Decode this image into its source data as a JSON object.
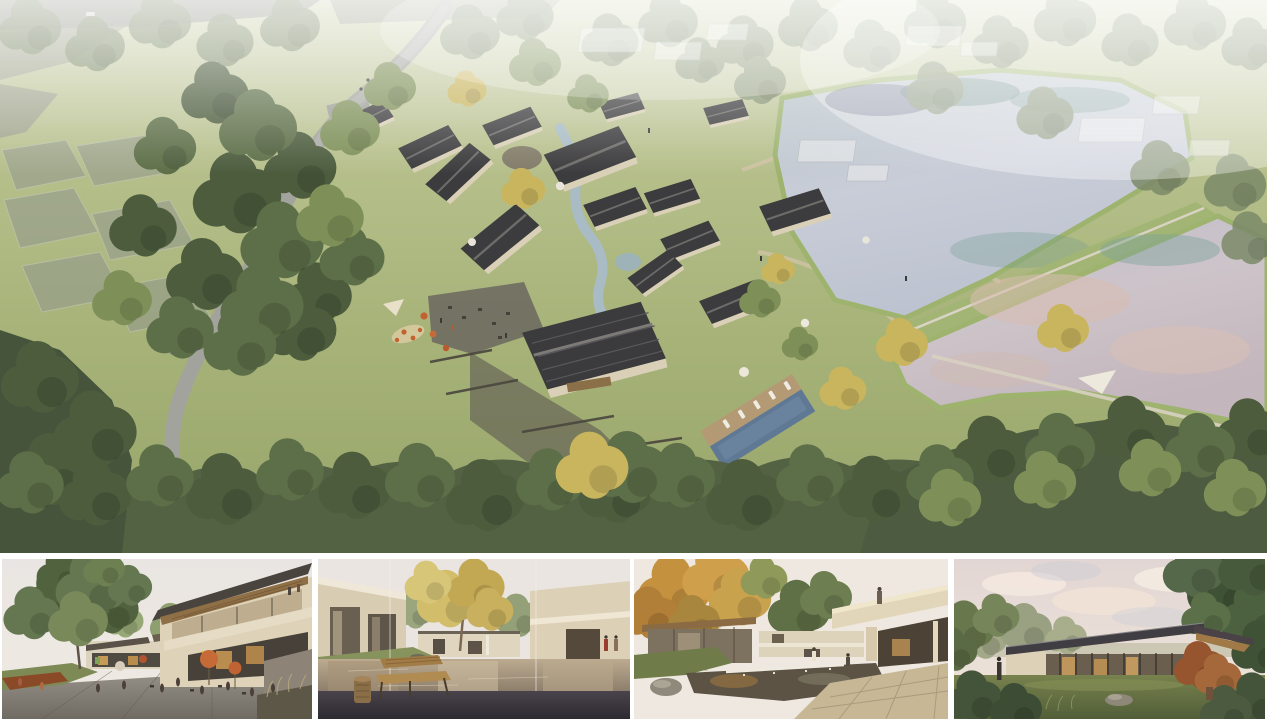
{
  "board": {
    "kind": "architectural rendering presentation board",
    "background": "#ffffff",
    "visible_text": "",
    "main_panel": {
      "alt": "Aerial rendering of a lakeside resort village: cream houses with dark gabled roofs clustered around courtyards and a winding stream, a grey road curving through tree groves on the left, semi-transparent context plots, two large ponds with a grass dike and footpath on the right, and a slanted lap pool with white sun loungers"
    },
    "thumbnails": [
      {
        "alt": "Eye-level rendering of a village plaza with outdoor cafe tables under orange umbrellas, a large green tree on the left and a two-storey building with timber roof soffit on the right"
      },
      {
        "alt": "Eye-level rendering of a reflecting pond courtyard between cream buildings with a yellow-leaved tree, a wooden bench and stool on a dark stone deck in the foreground"
      },
      {
        "alt": "Eye-level rendering of a garden courtyard with a weir waterfall pond, an autumn tree on the left and a cantilevered cream balcony with a person standing on it"
      },
      {
        "alt": "Eye-level rendering of a single-storey glass pavilion with a dark pitched roof on a lawn, framed by trees under a pink evening sky"
      }
    ],
    "palette": {
      "grass": "#a7b379",
      "tree_dark": "#4c5c3d",
      "tree_light": "#7e9058",
      "tree_yellow": "#c9b55e",
      "roof_dark": "#3c3b3d",
      "wall_cream": "#d9d0b7",
      "road_grey": "#a2a39d",
      "upper_lake": "#c7cbd6",
      "lower_lake": "#cbc2c9",
      "lake_teal": "#5f8a80",
      "pool_blue": "#5f7894",
      "umbrella_orange": "#c66a38",
      "deck_wood": "#b49a74",
      "sky_pink": "#ecdcd4"
    }
  }
}
